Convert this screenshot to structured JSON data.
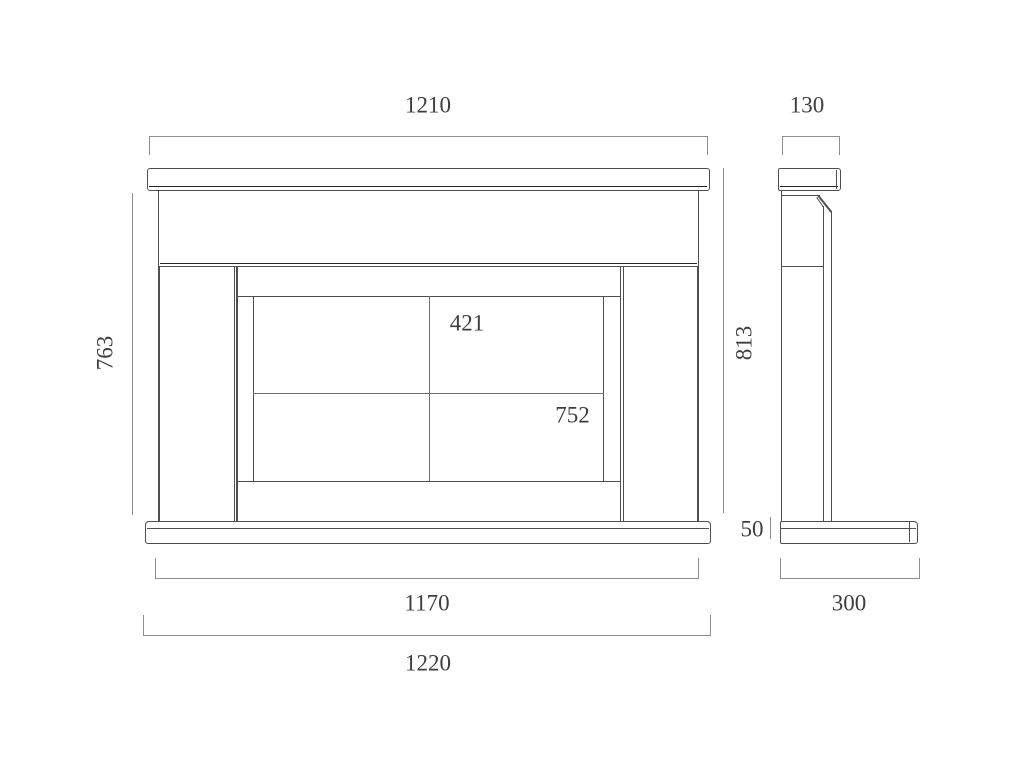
{
  "front_view": {
    "shelf_width": "1210",
    "surround_height": "763",
    "overall_height": "813",
    "opening_height": "421",
    "opening_width": "752",
    "plinth_height": "50",
    "body_width": "1170",
    "plinth_width": "1220"
  },
  "side_view": {
    "shelf_depth": "130",
    "plinth_depth": "300"
  },
  "colors": {
    "background": "#ffffff",
    "outline": "#4f4f4f",
    "shadow_line": "#262626",
    "dimension_line": "#8e8e8e",
    "label_text": "#3e3e3e"
  }
}
